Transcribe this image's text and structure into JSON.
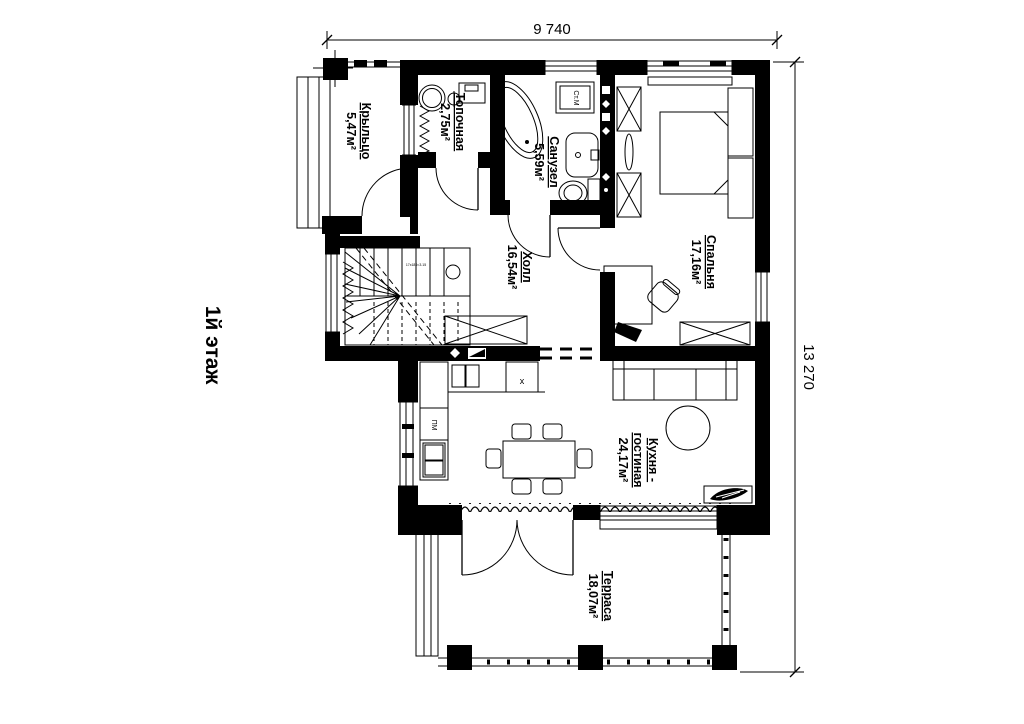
{
  "page": {
    "background": "#ffffff",
    "ink": "#000000"
  },
  "title_block": {
    "floor_label": "1й этаж"
  },
  "dimensions": {
    "top": "9 740",
    "right": "13 270"
  },
  "rooms": {
    "porch": {
      "name": "Крыльцо",
      "area": "5,47м²"
    },
    "boiler": {
      "name": "Топочная",
      "area": "2,75м²"
    },
    "bathroom": {
      "name": "Санузел",
      "area": "5,59м²"
    },
    "bedroom": {
      "name": "Спальня",
      "area": "17,16м²"
    },
    "hall": {
      "name": "Холл",
      "area": "16,54м²"
    },
    "kitchen_living": {
      "name_line1": "Кухня -",
      "name_line2": "гостиная",
      "area": "24,17м²"
    },
    "terrace": {
      "name": "Терраса",
      "area": "18,07м²"
    }
  },
  "appliances": {
    "washing_machine": "Ст.М",
    "dishwasher": "ПМ",
    "sink_mark": "x",
    "stair_note": "17x180=3.15"
  }
}
